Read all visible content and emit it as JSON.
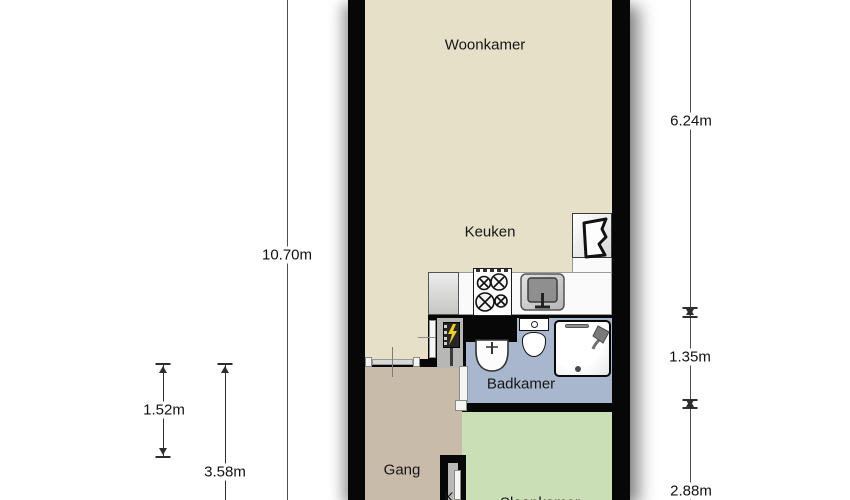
{
  "plan_title": "Apartment floor plan",
  "rooms": {
    "woonkamer": {
      "label": "Woonkamer"
    },
    "keuken": {
      "label": "Keuken"
    },
    "badkamer": {
      "label": "Badkamer"
    },
    "gang": {
      "label": "Gang"
    },
    "slaapkamer": {
      "label": "Slaapkamer"
    },
    "kast": {
      "label": "K"
    }
  },
  "dimensions": {
    "left_total": "10.70m",
    "left_upper": "1.52m",
    "left_lower": "3.58m",
    "right_top": "6.24m",
    "right_middle": "1.35m",
    "right_bottom": "2.88m"
  },
  "colors": {
    "wall": "#070707",
    "floor_living_kitchen": "#e6e0c8",
    "floor_hallway": "#c9bbaa",
    "floor_bathroom": "#a8b6ce",
    "floor_bedroom": "#cadfb6",
    "meter_cupboard": "#b7b7b5",
    "lightning_bolt": "#f0d020"
  },
  "icons": {
    "stove-icon": "4-burner hob",
    "kitchen-sink-icon": "kitchen sink with faucet",
    "water-heater-icon": "wall heater / geyser symbol",
    "washbasin-icon": "bathroom washbasin",
    "toilet-icon": "toilet with cistern",
    "shower-icon": "shower tray with shower head",
    "electrical-panel-icon": "meter cupboard panel",
    "lightning-bolt-icon": "electricity symbol"
  }
}
